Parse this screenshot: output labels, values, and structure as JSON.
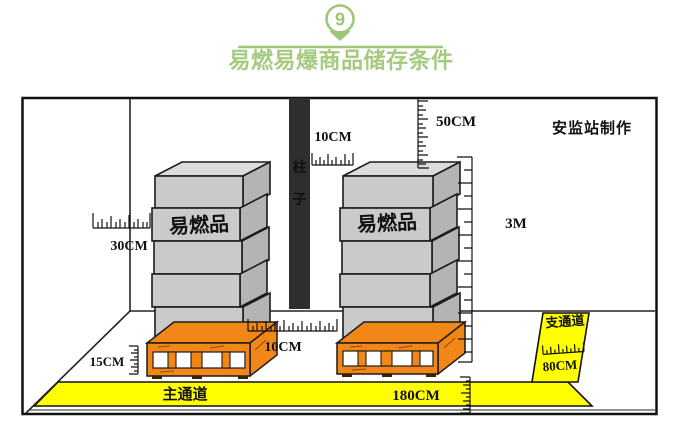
{
  "header": {
    "badge": "9",
    "title": "易燃易爆商品储存条件"
  },
  "diagram": {
    "credit": "安监站制作",
    "column": {
      "chars": [
        "柱",
        "子"
      ]
    },
    "stacks": {
      "left_label": "易燃品",
      "right_label": "易燃品"
    },
    "aisles": {
      "main_label": "主通道",
      "branch_label": "支通道"
    },
    "measurements": {
      "wall_clearance": "30CM",
      "column_clearance": "10CM",
      "ceiling_clearance": "50CM",
      "max_stack_height": "3M",
      "pallet_height": "15CM",
      "stack_gap": "10CM",
      "main_aisle_width": "180CM",
      "branch_aisle_width": "80CM"
    },
    "colors": {
      "accent_green": "#9fc77c",
      "box_gray": "#cacaca",
      "pallet_orange": "#f28718",
      "aisle_yellow": "#ffff00",
      "column_black": "#2e2e2e"
    }
  }
}
